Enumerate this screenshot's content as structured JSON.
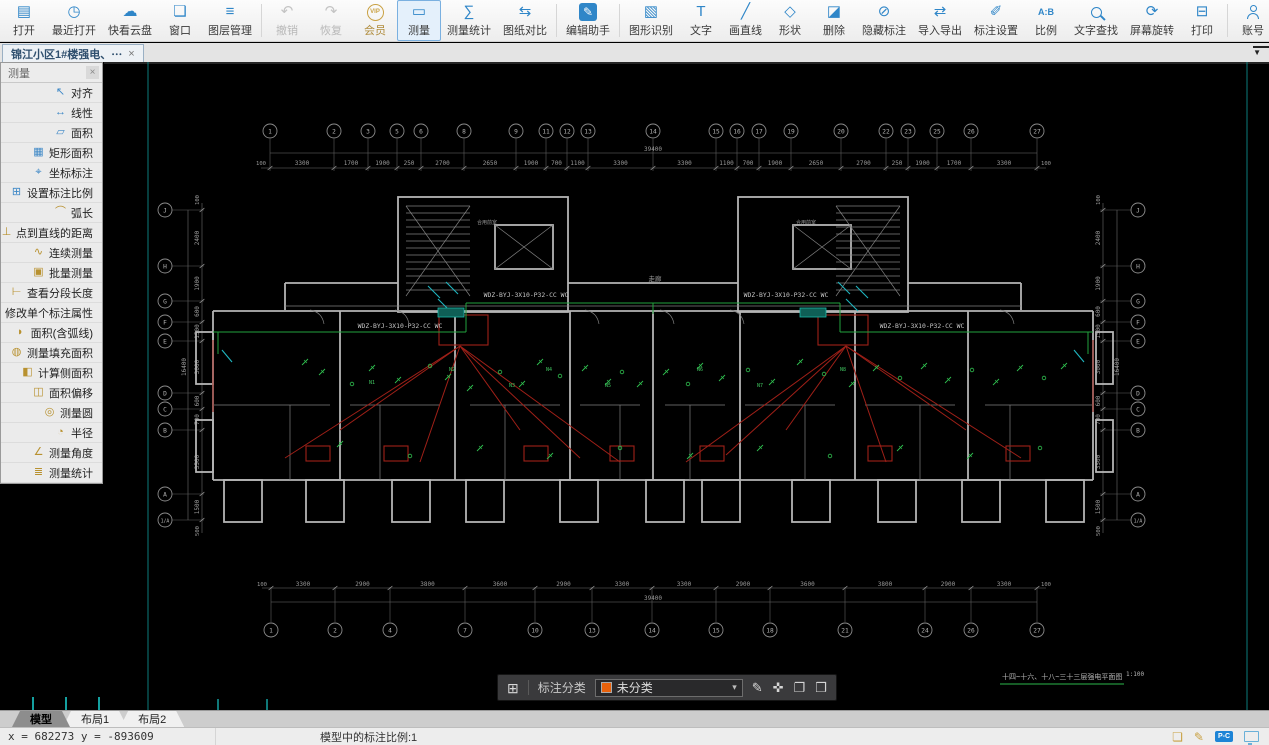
{
  "window": {
    "doc_tab": {
      "title": "锦江小区1#楼强电、⋯",
      "close": "×"
    },
    "tab_overflow": "▼"
  },
  "toolbar": {
    "items": [
      {
        "id": "open",
        "label": "打开",
        "icon": "▤"
      },
      {
        "id": "recent-open",
        "label": "最近打开",
        "icon": "◷"
      },
      {
        "id": "cloud-drive",
        "label": "快看云盘",
        "icon": "☁"
      },
      {
        "id": "window",
        "label": "窗口",
        "icon": "❏"
      },
      {
        "id": "layer-manager",
        "label": "图层管理",
        "icon": "≡"
      },
      {
        "sep": true
      },
      {
        "id": "undo",
        "label": "撤销",
        "icon": "↶",
        "state": "disabled"
      },
      {
        "id": "redo",
        "label": "恢复",
        "icon": "↷",
        "state": "disabled"
      },
      {
        "id": "vip-member",
        "label": "会员",
        "icon": "VIP",
        "state": "vip"
      },
      {
        "id": "measure",
        "label": "测量",
        "icon": "▭",
        "state": "active"
      },
      {
        "id": "measure-stats",
        "label": "测量统计",
        "icon": "∑"
      },
      {
        "id": "drawing-compare",
        "label": "图纸对比",
        "icon": "⇆"
      },
      {
        "sep": true
      },
      {
        "id": "edit-assistant",
        "label": "编辑助手",
        "icon": "✎",
        "state": "primary"
      },
      {
        "sep": true
      },
      {
        "id": "shape-recognition",
        "label": "图形识别",
        "icon": "▧"
      },
      {
        "id": "text",
        "label": "文字",
        "icon": "T"
      },
      {
        "id": "draw-line",
        "label": "画直线",
        "icon": "╱"
      },
      {
        "id": "shapes",
        "label": "形状",
        "icon": "◇"
      },
      {
        "id": "delete",
        "label": "删除",
        "icon": "◪"
      },
      {
        "id": "hide-annotation",
        "label": "隐藏标注",
        "icon": "⊘"
      },
      {
        "id": "import-export",
        "label": "导入导出",
        "icon": "⇄"
      },
      {
        "id": "annotation-settings",
        "label": "标注设置",
        "icon": "✐"
      },
      {
        "id": "scale-ratio",
        "label": "比例",
        "icon": "A:B",
        "state": "ab"
      },
      {
        "id": "text-search",
        "label": "文字查找",
        "css": "ico-mag"
      },
      {
        "id": "screen-rotate",
        "label": "屏幕旋转",
        "icon": "⟳"
      },
      {
        "id": "print",
        "label": "打印",
        "icon": "⊟"
      },
      {
        "sep": true
      },
      {
        "id": "account",
        "label": "账号",
        "css": "ico-person"
      },
      {
        "id": "support",
        "label": "客服",
        "css": "ico-headset"
      },
      {
        "id": "style",
        "label": "风格",
        "icon": "❖"
      },
      {
        "id": "about",
        "label": "关于",
        "icon": "ⓘ"
      },
      {
        "id": "apps",
        "label": "应用",
        "icon": "◈"
      }
    ]
  },
  "measure_panel": {
    "title": "测量",
    "close": "×",
    "items": [
      {
        "id": "align",
        "label": "对齐",
        "icon": "↖",
        "color": "blue"
      },
      {
        "id": "linear",
        "label": "线性",
        "icon": "↔",
        "color": "blue"
      },
      {
        "id": "area",
        "label": "面积",
        "icon": "▱",
        "color": "blue"
      },
      {
        "id": "rect-area",
        "label": "矩形面积",
        "icon": "▦",
        "color": "blue"
      },
      {
        "id": "coordinate-annotation",
        "label": "坐标标注",
        "icon": "⌖",
        "color": "blue"
      },
      {
        "id": "set-annotation-scale",
        "label": "设置标注比例",
        "icon": "⊞",
        "color": "blue"
      },
      {
        "id": "arc-length",
        "label": "弧长",
        "icon": "⌒",
        "color": "gold"
      },
      {
        "id": "point-to-line-distance",
        "label": "点到直线的距离",
        "icon": "⊥",
        "color": "gold"
      },
      {
        "id": "continuous-measure",
        "label": "连续测量",
        "icon": "∿",
        "color": "gold"
      },
      {
        "id": "batch-measure",
        "label": "批量测量",
        "icon": "▣",
        "color": "gold"
      },
      {
        "id": "view-segment-length",
        "label": "查看分段长度",
        "icon": "⊢",
        "color": "gold"
      },
      {
        "id": "modify-annotation-property",
        "label": "修改单个标注属性",
        "icon": "✎",
        "color": "gold"
      },
      {
        "id": "area-with-arc",
        "label": "面积(含弧线)",
        "icon": "◗",
        "color": "gold"
      },
      {
        "id": "measure-fill-area",
        "label": "测量填充面积",
        "icon": "◍",
        "color": "gold"
      },
      {
        "id": "calc-side-area",
        "label": "计算侧面积",
        "icon": "◧",
        "color": "gold"
      },
      {
        "id": "area-offset",
        "label": "面积偏移",
        "icon": "◫",
        "color": "gold"
      },
      {
        "id": "measure-circle",
        "label": "测量圆",
        "icon": "◎",
        "color": "gold"
      },
      {
        "id": "radius",
        "label": "半径",
        "icon": "◔",
        "color": "gold"
      },
      {
        "id": "measure-angle",
        "label": "测量角度",
        "icon": "∠",
        "color": "gold"
      },
      {
        "id": "measure-statistics",
        "label": "测量统计",
        "icon": "≣",
        "color": "gold"
      }
    ]
  },
  "classify_bar": {
    "grid_icon": "⊞",
    "label": "标注分类",
    "selected": "未分类",
    "swatch_color": "#e8610c",
    "caret": "▾",
    "buttons": [
      {
        "id": "edit",
        "icon": "✎"
      },
      {
        "id": "move",
        "icon": "✜"
      },
      {
        "id": "copy",
        "icon": "❐"
      },
      {
        "id": "paste",
        "icon": "❒"
      }
    ]
  },
  "sheet_tabs": [
    {
      "label": "模型",
      "active": true
    },
    {
      "label": "布局1",
      "active": false
    },
    {
      "label": "布局2",
      "active": false
    }
  ],
  "status_bar": {
    "coords": "x = 682273 y = -893609",
    "scale_text": "模型中的标注比例:1",
    "pc_badge": "P-C"
  },
  "drawing": {
    "wiring_label": "WDZ-BYJ-3X10-P32-CC WC",
    "wiring_label_centers": [
      [
        400,
        328
      ],
      [
        526,
        297
      ],
      [
        786,
        297
      ],
      [
        922,
        328
      ]
    ],
    "room_labels": [
      {
        "t": "走廊",
        "x": 655,
        "y": 281,
        "s": 6.5
      },
      {
        "t": "合用前室",
        "x": 487,
        "y": 224,
        "s": 5
      },
      {
        "t": "合用前室",
        "x": 806,
        "y": 224,
        "s": 5
      }
    ],
    "unit_labels": [
      [
        "N1",
        372,
        384
      ],
      [
        "N2",
        452,
        371
      ],
      [
        "N3",
        512,
        387
      ],
      [
        "N4",
        549,
        371
      ],
      [
        "N5",
        608,
        387
      ],
      [
        "N6",
        700,
        371
      ],
      [
        "N7",
        760,
        387
      ],
      [
        "N8",
        843,
        371
      ]
    ],
    "grid_top": {
      "y": 131,
      "bubbles": [
        [
          "1",
          270
        ],
        [
          "2",
          334
        ],
        [
          "3",
          368
        ],
        [
          "5",
          397
        ],
        [
          "6",
          421
        ],
        [
          "8",
          464
        ],
        [
          "9",
          516
        ],
        [
          "11",
          546
        ],
        [
          "12",
          567
        ],
        [
          "13",
          588
        ],
        [
          "14",
          653
        ],
        [
          "15",
          716
        ],
        [
          "16",
          737
        ],
        [
          "17",
          759
        ],
        [
          "19",
          791
        ],
        [
          "20",
          841
        ],
        [
          "22",
          886
        ],
        [
          "23",
          908
        ],
        [
          "25",
          937
        ],
        [
          "26",
          971
        ],
        [
          "27",
          1037
        ]
      ]
    },
    "grid_bottom": {
      "y": 630,
      "bubbles": [
        [
          "1",
          271
        ],
        [
          "2",
          335
        ],
        [
          "4",
          390
        ],
        [
          "7",
          465
        ],
        [
          "10",
          535
        ],
        [
          "13",
          592
        ],
        [
          "14",
          652
        ],
        [
          "15",
          716
        ],
        [
          "18",
          770
        ],
        [
          "21",
          845
        ],
        [
          "24",
          925
        ],
        [
          "26",
          971
        ],
        [
          "27",
          1037
        ]
      ]
    },
    "grid_left": {
      "x": 165,
      "bubbles": [
        [
          "J",
          210
        ],
        [
          "H",
          266
        ],
        [
          "G",
          301
        ],
        [
          "F",
          322
        ],
        [
          "E",
          341
        ],
        [
          "D",
          393
        ],
        [
          "C",
          409
        ],
        [
          "B",
          430
        ],
        [
          "A",
          494
        ],
        [
          "1/A",
          520
        ]
      ]
    },
    "grid_right": {
      "x": 1138
    },
    "dims_top": [
      "3300",
      "1700",
      "1900",
      "250",
      "2700",
      "2650",
      "1900",
      "700",
      "1100",
      "3300",
      "3300",
      "1100",
      "700",
      "1900",
      "2650",
      "2700",
      "250",
      "1900",
      "1700",
      "3300"
    ],
    "dims_bottom": [
      "3300",
      "2900",
      "3800",
      "3600",
      "2900",
      "3300",
      "3300",
      "2900",
      "3600",
      "3800",
      "2900",
      "3300"
    ],
    "dims_left": [
      "2400",
      "1900",
      "600",
      "1500",
      "3000",
      "600",
      "700",
      "3500",
      "1500"
    ],
    "dim_extra_below": "500",
    "end_dim": "100",
    "overall_h": "39400",
    "overall_v": "16400",
    "title": "十四~十六、十八~三十三层强电平面图",
    "scale": "1:100"
  }
}
